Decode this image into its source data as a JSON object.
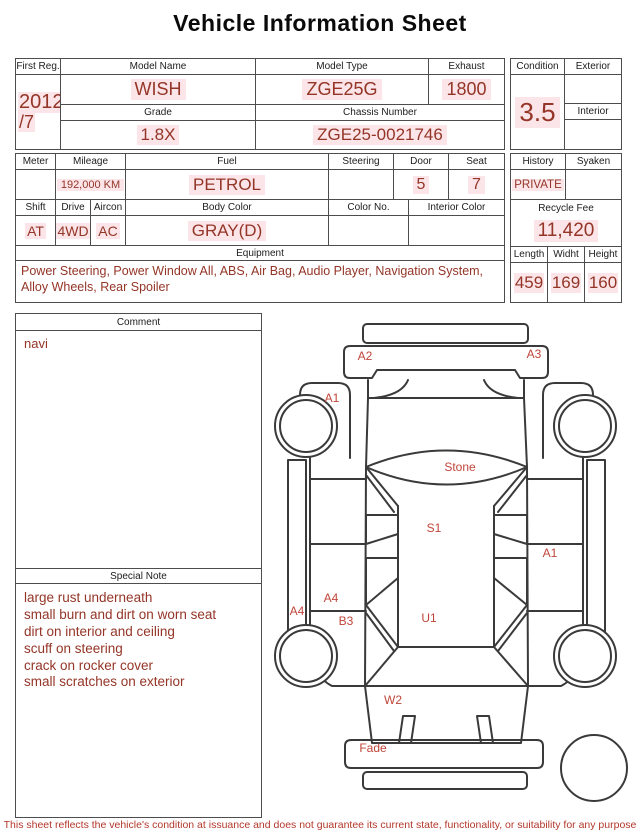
{
  "title": "Vehicle Information Sheet",
  "info": {
    "first_reg_label": "First Reg.",
    "first_reg_year": "2012",
    "first_reg_month": "/7",
    "model_name_label": "Model Name",
    "model_name": "WISH",
    "model_type_label": "Model Type",
    "model_type": "ZGE25G",
    "exhaust_label": "Exhaust",
    "exhaust": "1800",
    "grade_label": "Grade",
    "grade": "1.8X",
    "chassis_number_label": "Chassis Number",
    "chassis_number": "ZGE25-0021746",
    "condition_label": "Condition",
    "condition": "3.5",
    "exterior_label": "Exterior",
    "exterior": "",
    "interior_label": "Interior",
    "interior": ""
  },
  "details": {
    "meter_label": "Meter",
    "meter": "",
    "mileage_label": "Mileage",
    "mileage": "192,000 KM",
    "fuel_label": "Fuel",
    "fuel": "PETROL",
    "steering_label": "Steering",
    "steering": "",
    "door_label": "Door",
    "door": "5",
    "seat_label": "Seat",
    "seat": "7",
    "shift_label": "Shift",
    "shift": "AT",
    "drive_label": "Drive",
    "drive": "4WD",
    "aircon_label": "Aircon",
    "aircon": "AC",
    "body_color_label": "Body Color",
    "body_color": "GRAY(D)",
    "color_no_label": "Color No.",
    "color_no": "",
    "interior_color_label": "Interior Color",
    "interior_color": "",
    "equipment_label": "Equipment",
    "equipment": "Power Steering, Power Window  All, ABS, Air Bag, Audio Player, Navigation System, Alloy Wheels, Rear Spoiler"
  },
  "right_panel": {
    "history_label": "History",
    "history": "PRIVATE",
    "syaken_label": "Syaken",
    "syaken": "",
    "recycle_fee_label": "Recycle Fee",
    "recycle_fee": "11,420",
    "length_label": "Length",
    "length": "459",
    "width_label": "Widht",
    "width": "169",
    "height_label": "Height",
    "height": "160"
  },
  "comment": {
    "label": "Comment",
    "text": "navi"
  },
  "special_note": {
    "label": "Special Note",
    "lines": [
      "large rust underneath",
      "small burn and dirt on worn seat",
      "dirt on interior and ceiling",
      "scuff on steering",
      "crack on rocker cover",
      "small scratches on exterior"
    ]
  },
  "diagram": {
    "labels": {
      "a2": "A2",
      "a3": "A3",
      "a1_front_left": "A1",
      "stone": "Stone",
      "s1": "S1",
      "a1_right": "A1",
      "a4_door": "A4",
      "a4_sill": "A4",
      "b3": "B3",
      "u1": "U1",
      "w2": "W2",
      "fade": "Fade"
    }
  },
  "footer": "This sheet reflects the vehicle's condition at issuance and does not guarantee its current state, functionality, or suitability for any purpose",
  "colors": {
    "value_red": "#943527",
    "label_red": "#c0453a",
    "line": "#3a3a3a",
    "border": "#4d4d4d"
  }
}
